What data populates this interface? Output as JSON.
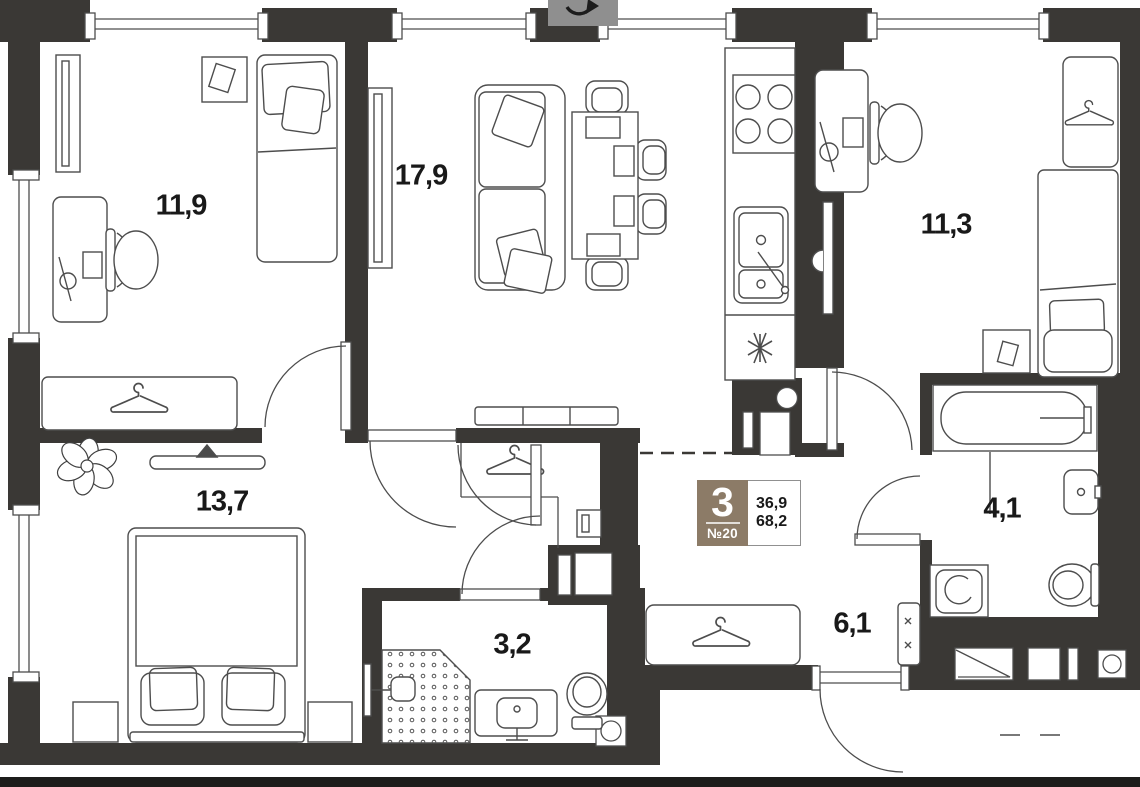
{
  "unit_badge": {
    "rooms_count": "3",
    "unit_number": "№20",
    "living_area": "36,9",
    "total_area": "68,2"
  },
  "room_areas": {
    "bedroom_top_left": "11,9",
    "living_room": "17,9",
    "bedroom_top_right": "11,3",
    "bedroom_bottom_left": "13,7",
    "shower_room": "3,2",
    "hallway": "6,1",
    "bathroom": "4,1"
  },
  "icons": [
    "compass-rotation-icon",
    "hanger-icon",
    "single-bed-icon",
    "double-bed-icon",
    "sofa-icon",
    "dining-table-icon",
    "desk-icon",
    "office-chair-icon",
    "stove-icon",
    "kitchen-sink-icon",
    "fridge-icon",
    "bathtub-icon",
    "toilet-icon",
    "washbasin-icon",
    "washing-machine-icon",
    "shower-icon",
    "plant-icon",
    "tv-icon",
    "electrical-panel-icon",
    "vent-icon",
    "door-arc",
    "window"
  ],
  "colors": {
    "wall": "#3a3835",
    "badge_brown": "#8c7b67",
    "furniture_line": "#4d4d4d",
    "text": "#191919"
  }
}
